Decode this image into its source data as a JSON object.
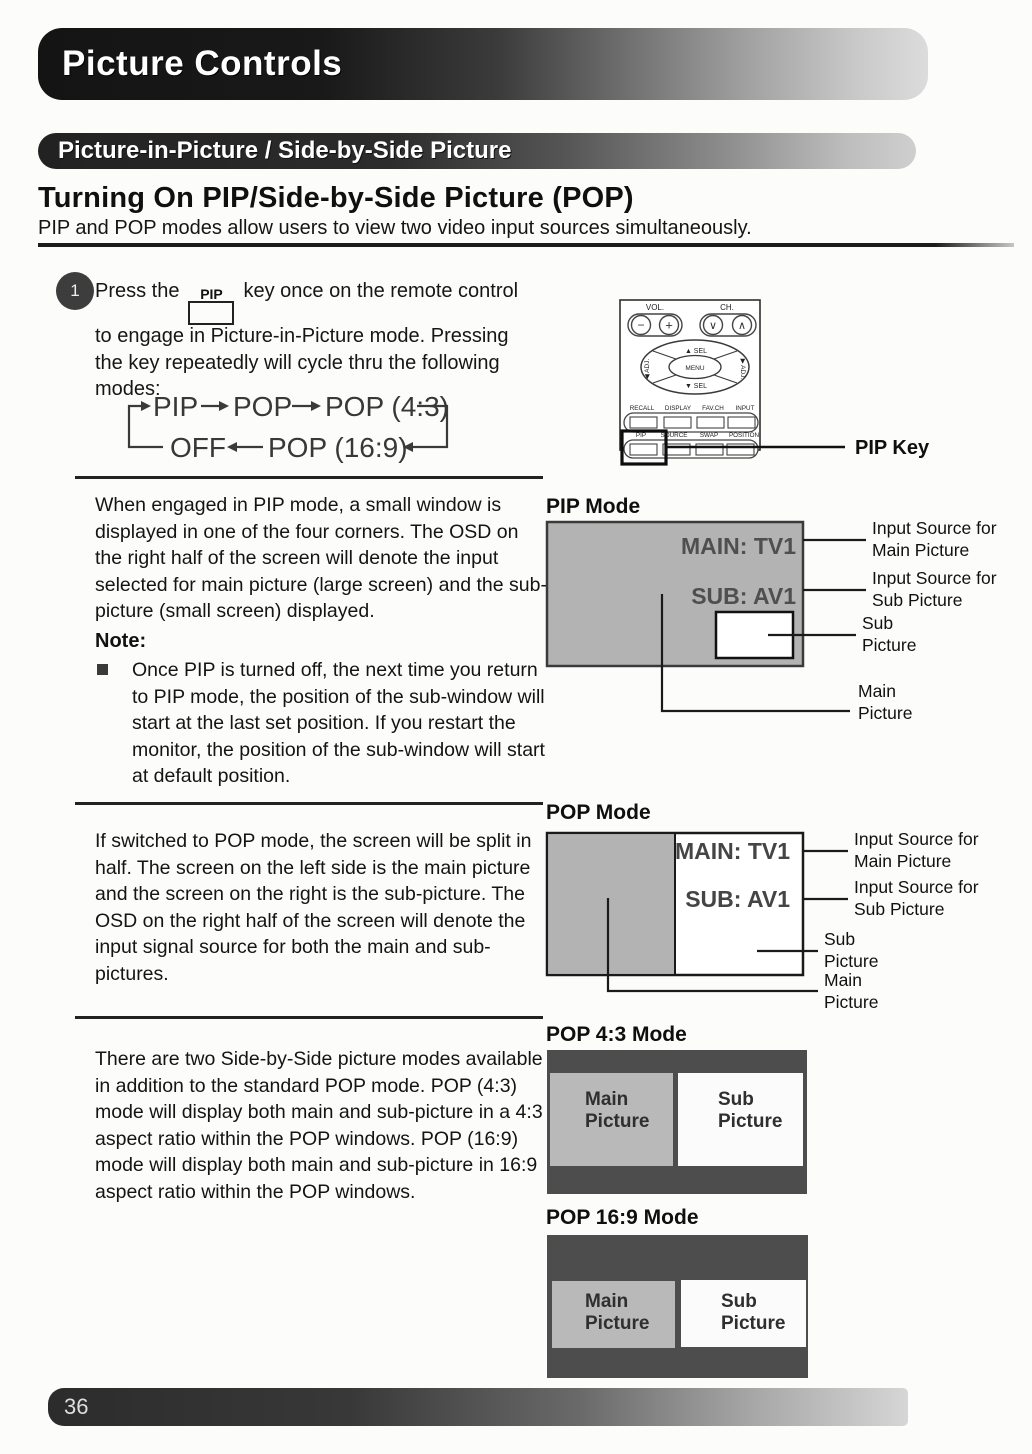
{
  "page": {
    "title": "Picture Controls",
    "section_title": "Picture-in-Picture / Side-by-Side Picture",
    "heading": "Turning On PIP/Side-by-Side Picture (POP)",
    "intro": "PIP and POP modes allow users to view two video input sources simultaneously.",
    "page_number": "36"
  },
  "step1": {
    "number": "1",
    "line1_pre": "Press the",
    "key_cap": "PIP",
    "line1_post": "key once on the remote control",
    "line2": "to engage in Picture-in-Picture mode.  Pressing",
    "line3": "the key repeatedly will cycle thru the following",
    "line4": "modes:",
    "cycle": {
      "pip": "PIP",
      "pop": "POP",
      "pop43": "POP (4:3)",
      "off": "OFF",
      "pop169": "POP (16:9)"
    }
  },
  "remote": {
    "vol": "VOL.",
    "ch": "CH.",
    "sel_up": "▲ SEL",
    "sel_down": "▼ SEL",
    "adj_left": "◀ ADJ.",
    "adj_right": "▶ ADJ.",
    "menu": "MENU",
    "row1": [
      "RECALL",
      "DISPLAY",
      "FAV.CH",
      "INPUT"
    ],
    "row2": [
      "PIP",
      "SOURCE",
      "SWAP",
      "POSITION"
    ],
    "minus": "−",
    "plus": "+",
    "ch_down": "∨",
    "ch_up": "∧",
    "callout": "PIP Key"
  },
  "pip": {
    "body": "When engaged in PIP mode, a small window is displayed in one of the four corners.  The OSD on the right half of the screen will denote the input selected for main picture (large screen) and the sub-picture (small screen) displayed.",
    "note_title": "Note:",
    "note_item": "Once PIP is turned off, the next time you return to PIP mode, the position of the sub-window will start at the last set position.  If you restart the monitor, the position of the sub-window will start at default position.",
    "diagram_title": "PIP Mode",
    "osd_main": "MAIN: TV1",
    "osd_sub": "SUB:  AV1"
  },
  "pop": {
    "body": "If switched to POP mode, the screen will be split in half.  The screen on the left side is the main picture and the screen on the right is the sub-picture.  The OSD on the right half of the screen will denote the input signal source for both the main and sub-pictures.",
    "diagram_title": "POP Mode",
    "osd_main": "MAIN: TV1",
    "osd_sub": "SUB:  AV1"
  },
  "callouts": {
    "input_main": [
      "Input Source for",
      "Main Picture"
    ],
    "input_sub": [
      "Input Source for",
      "Sub Picture"
    ],
    "sub": [
      "Sub",
      "Picture"
    ],
    "main": [
      "Main",
      "Picture"
    ]
  },
  "sbs": {
    "body": "There are two Side-by-Side picture modes available in addition to the standard POP mode.  POP (4:3) mode will display both main and sub-picture in a 4:3 aspect ratio within the POP windows.  POP (16:9) mode will display both main and sub-picture in 16:9 aspect ratio within the POP windows.",
    "pop43_title": "POP 4:3 Mode",
    "pop169_title": "POP 16:9 Mode",
    "main_label": [
      "Main",
      "Picture"
    ],
    "sub_label": [
      "Sub",
      "Picture"
    ]
  },
  "colors": {
    "screen_gray": "#b3b3b3",
    "panel_dark": "#4d4d4d",
    "ink": "#1b1b1b"
  }
}
